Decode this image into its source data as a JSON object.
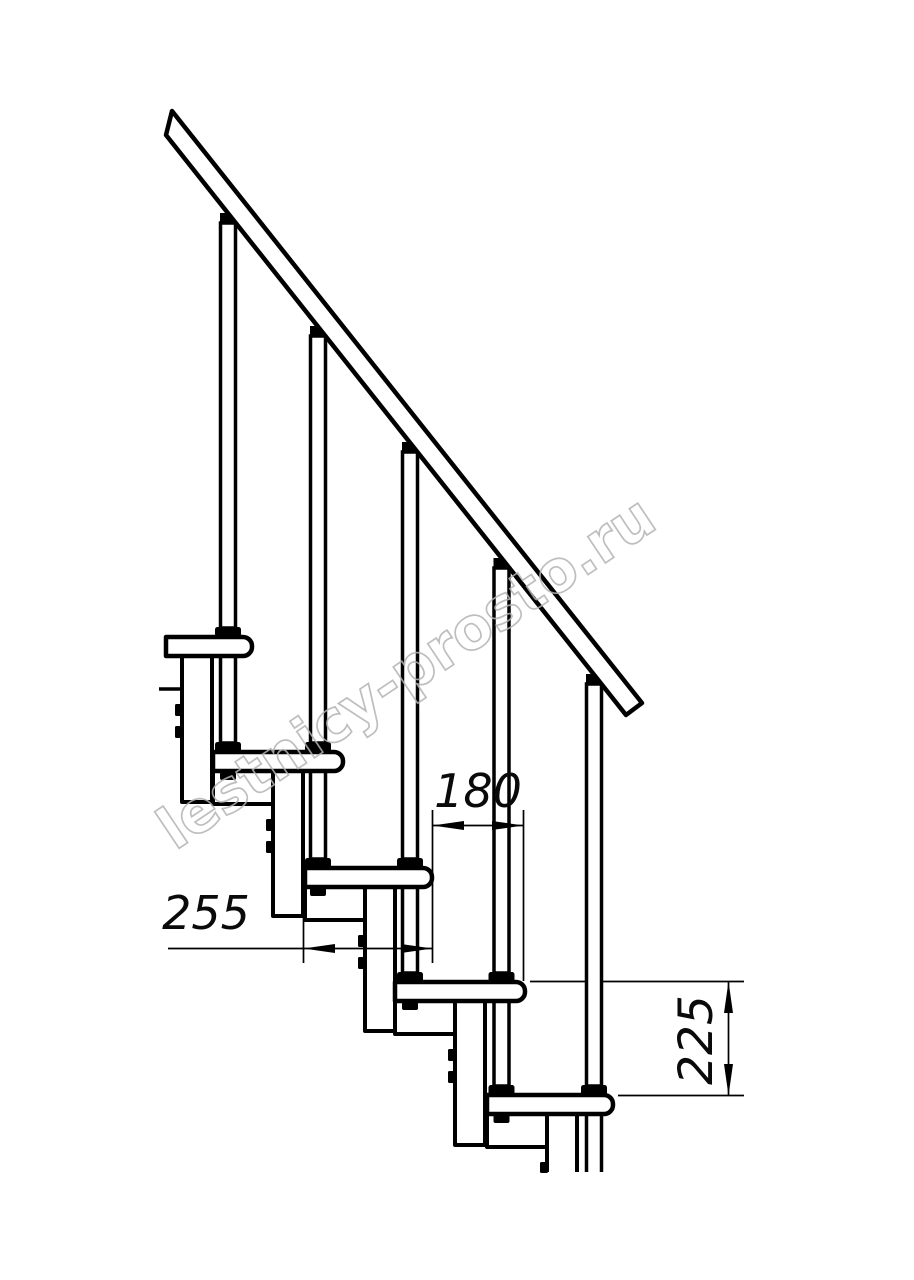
{
  "drawing": {
    "subject": "modular staircase side elevation",
    "background": "#ffffff",
    "line_color": "#000000",
    "counts": {
      "treads": 5,
      "balusters": 5
    },
    "dimensions": {
      "run": {
        "value": "180",
        "orientation": "horizontal"
      },
      "depth": {
        "value": "255",
        "orientation": "horizontal"
      },
      "rise": {
        "value": "225",
        "orientation": "vertical"
      }
    },
    "watermark": {
      "text": "lestnicy-prosto.ru",
      "color": "#b3b3b3"
    }
  }
}
